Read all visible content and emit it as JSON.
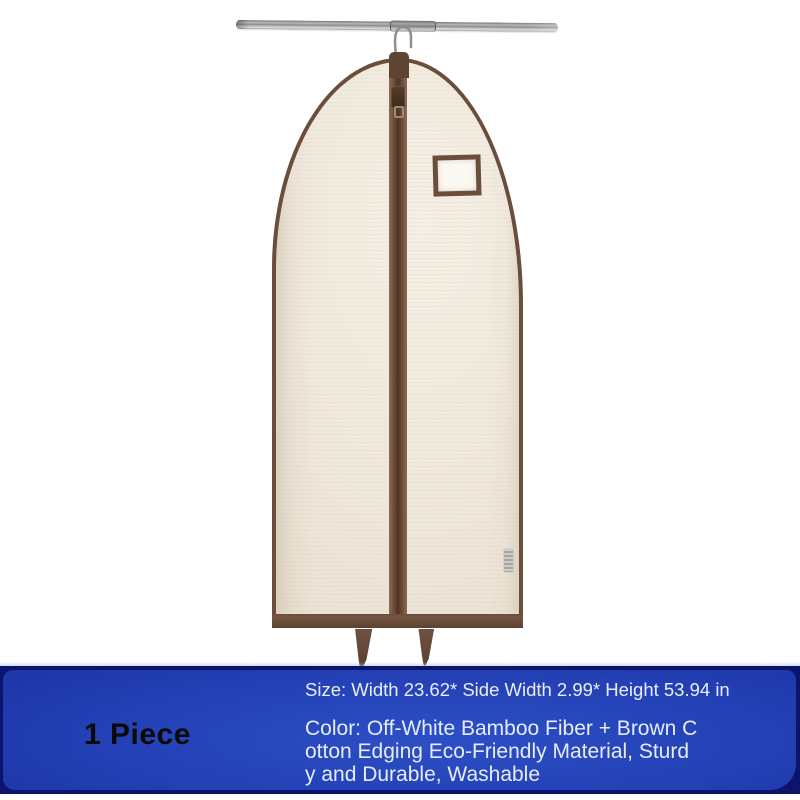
{
  "banner": {
    "quantity": "1 Piece",
    "size_line": "Size: Width 23.62* Side Width 2.99* Height 53.94 in",
    "color_line_1": "Color: Off-White Bamboo Fiber + Brown C",
    "color_line_2": "otton Edging Eco-Friendly Material, Sturd",
    "color_line_3": "y and Durable, Washable",
    "background_color": "#1e38ab",
    "highlight_color": "#2d4fc6",
    "border_color": "#0c156b",
    "text_color": "#e9eefb",
    "quantity_text_color": "#0a0a0b"
  },
  "scene": {
    "background_color": "#ffffff",
    "bag_fabric_color": "#efe8db",
    "bag_trim_color": "#6b4d3b",
    "zipper_color": "#5f4431",
    "rod_color": "#9a9a9a",
    "hook_color": "#8f8f8f",
    "side_tag_color": "#c9c8c3"
  }
}
